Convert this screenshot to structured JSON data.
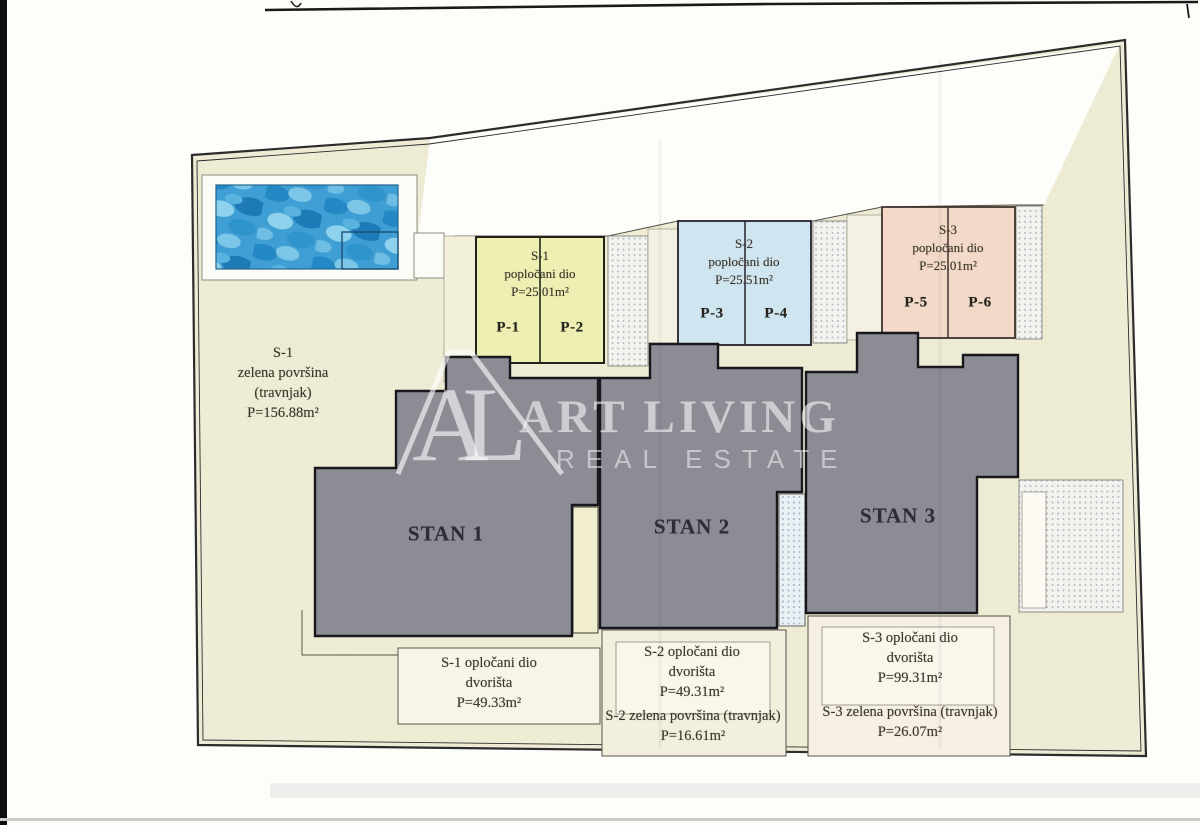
{
  "watermark": {
    "initials": "AL",
    "line1": "ART LIVING",
    "line2": "REAL ESTATE"
  },
  "site": {
    "green_s1": {
      "l1": "S-1",
      "l2": "zelena površina",
      "l3": "(travnjak)",
      "l4": "P=156.88m²"
    },
    "parking": [
      {
        "unit": "S-1",
        "kind": "popločani dio",
        "area": "P=25.01m²",
        "stall_a": "P-1",
        "stall_b": "P-2"
      },
      {
        "unit": "S-2",
        "kind": "popločani dio",
        "area": "P=25.51m²",
        "stall_a": "P-3",
        "stall_b": "P-4"
      },
      {
        "unit": "S-3",
        "kind": "popločani dio",
        "area": "P=25.01m²",
        "stall_a": "P-5",
        "stall_b": "P-6"
      }
    ],
    "units": [
      {
        "label": "STAN 1"
      },
      {
        "label": "STAN 2"
      },
      {
        "label": "STAN 3"
      }
    ],
    "yards": [
      {
        "l1": "S-1 opločani dio",
        "l2": "dvorišta",
        "l3": "P=49.33m²"
      },
      {
        "l1": "S-2 opločani dio",
        "l2": "dvorišta",
        "l3": "P=49.31m²"
      },
      {
        "l1": "S-3 opločani dio",
        "l2": "dvorišta",
        "l3": "P=99.31m²"
      }
    ],
    "greens": [
      {
        "l1": "S-2 zelena površina (travnjak)",
        "l2": "P=16.61m²"
      },
      {
        "l1": "S-3 zelena površina (travnjak)",
        "l2": "P=26.07m²"
      }
    ]
  },
  "colors": {
    "parcel": "#efecd6",
    "pool_water": "#3f9fd4",
    "parking_s1": "#edefb3",
    "parking_s2": "#cfe5f0",
    "parking_s3": "#f2d9c8",
    "building": "#8c8c94",
    "boundary": "#2c2c2c",
    "watermark": "#ffffff"
  }
}
